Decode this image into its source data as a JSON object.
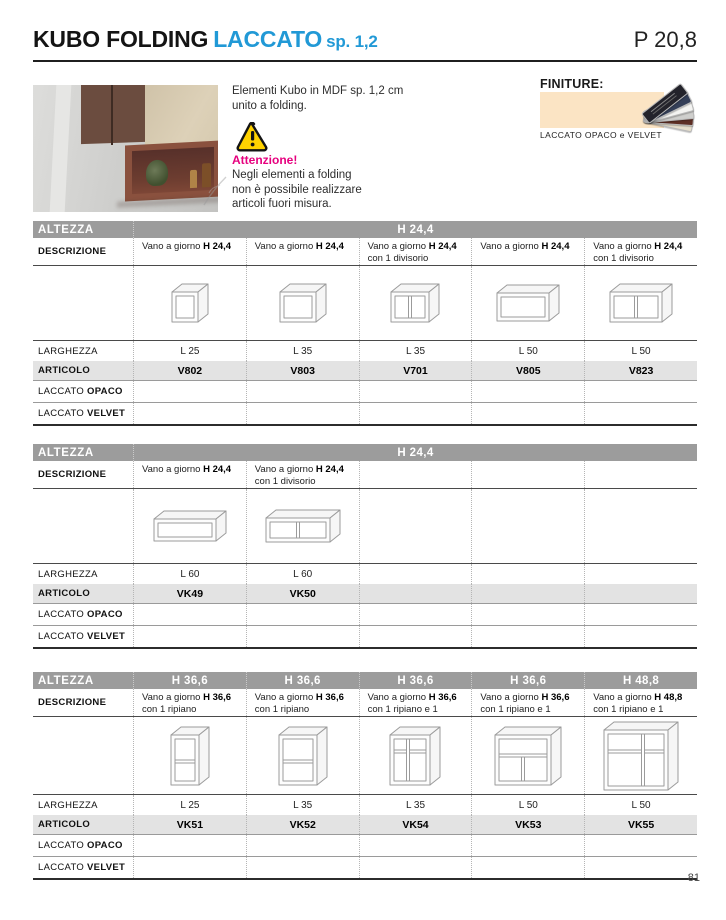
{
  "page": {
    "title_black": "KUBO FOLDING",
    "title_blue": "LACCATO",
    "title_small": "sp. 1,2",
    "page_ref": "P 20,8",
    "page_number": "81"
  },
  "intro": {
    "description_lines": [
      "Elementi Kubo in MDF sp. 1,2 cm",
      "unito a folding."
    ],
    "warning_title": "Attenzione!",
    "warning_lines": [
      "Negli elementi a folding",
      "non è possibile realizzare",
      "articoli fuori misura."
    ]
  },
  "finiture": {
    "label": "FINITURE:",
    "caption": "LACCATO OPACO e VELVET"
  },
  "labels": {
    "altezza": "ALTEZZA",
    "descrizione": "DESCRIZIONE",
    "larghezza": "LARGHEZZA",
    "articolo": "ARTICOLO",
    "laccato": "LACCATO",
    "opaco": "OPACO",
    "velvet": "VELVET"
  },
  "colors": {
    "accent_blue": "#2199d6",
    "warning_pink": "#e6007e",
    "header_gray": "#9c9c9c",
    "articolo_band": "#e3e3e3",
    "warning_yellow": "#ffd200",
    "swatch_cream": "#fbe4c4"
  },
  "tables": [
    {
      "altezza_span": "H 24,4",
      "columns": [
        {
          "descrizione": [
            "Vano a giorno H 24,4"
          ],
          "icon": "cube-25",
          "larghezza": "L 25",
          "articolo": "V802"
        },
        {
          "descrizione": [
            "Vano a giorno H 24,4"
          ],
          "icon": "cube-35",
          "larghezza": "L 35",
          "articolo": "V803"
        },
        {
          "descrizione": [
            "Vano a giorno H 24,4",
            "con 1 divisorio"
          ],
          "icon": "cube-35-div",
          "larghezza": "L 35",
          "articolo": "V701"
        },
        {
          "descrizione": [
            "Vano a giorno H 24,4"
          ],
          "icon": "box-50",
          "larghezza": "L 50",
          "articolo": "V805"
        },
        {
          "descrizione": [
            "Vano a giorno H 24,4",
            "con 1 divisorio"
          ],
          "icon": "box-50-div",
          "larghezza": "L 50",
          "articolo": "V823"
        }
      ]
    },
    {
      "altezza_span": "H 24,4",
      "columns": [
        {
          "descrizione": [
            "Vano a giorno H 24,4"
          ],
          "icon": "box-60",
          "larghezza": "L 60",
          "articolo": "VK49"
        },
        {
          "descrizione": [
            "Vano a giorno H 24,4",
            "con 1 divisorio"
          ],
          "icon": "box-60-div",
          "larghezza": "L 60",
          "articolo": "VK50"
        },
        {},
        {},
        {}
      ]
    },
    {
      "altezza_cols": [
        "H 36,6",
        "H 36,6",
        "H 36,6",
        "H 36,6",
        "H 48,8"
      ],
      "columns": [
        {
          "descrizione": [
            "Vano a giorno H 36,6",
            "con 1 ripiano"
          ],
          "icon": "tall-25-shelf",
          "larghezza": "L 25",
          "articolo": "VK51"
        },
        {
          "descrizione": [
            "Vano a giorno H 36,6",
            "con 1 ripiano"
          ],
          "icon": "tall-35-shelf",
          "larghezza": "L 35",
          "articolo": "VK52"
        },
        {
          "descrizione": [
            "Vano a giorno H 36,6",
            "con 1 ripiano e 1 divisorio"
          ],
          "icon": "tall-35-shelf-div",
          "larghezza": "L 35",
          "articolo": "VK54"
        },
        {
          "descrizione": [
            "Vano a giorno H 36,6",
            "con 1 ripiano e 1 divisorio"
          ],
          "icon": "tall-50-shelf-div",
          "larghezza": "L 50",
          "articolo": "VK53"
        },
        {
          "descrizione": [
            "Vano a giorno H 48,8",
            "con 1 ripiano e 1 divisorio"
          ],
          "icon": "tall-50-big-shelf-div",
          "larghezza": "L 50",
          "articolo": "VK55"
        }
      ]
    }
  ]
}
